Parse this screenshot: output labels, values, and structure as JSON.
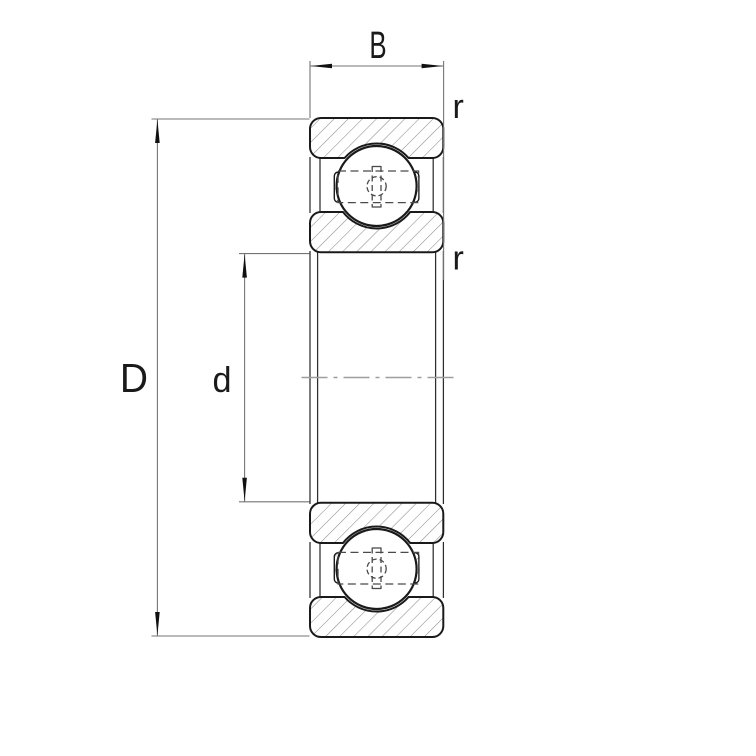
{
  "drawing": {
    "labels": {
      "width": "B",
      "outer_diameter": "D",
      "bore_diameter": "d",
      "outer_ring_corner_radius": "r",
      "inner_ring_corner_radius": "r"
    },
    "colors": {
      "outline": "#1a1a1a",
      "hatch": "#8c8c8c",
      "dimension_lines": "#757575",
      "arrowheads": "#111111",
      "hidden_lines": "#4a4a4a",
      "centerline": "#9e9e9e",
      "background": "#ffffff"
    }
  }
}
